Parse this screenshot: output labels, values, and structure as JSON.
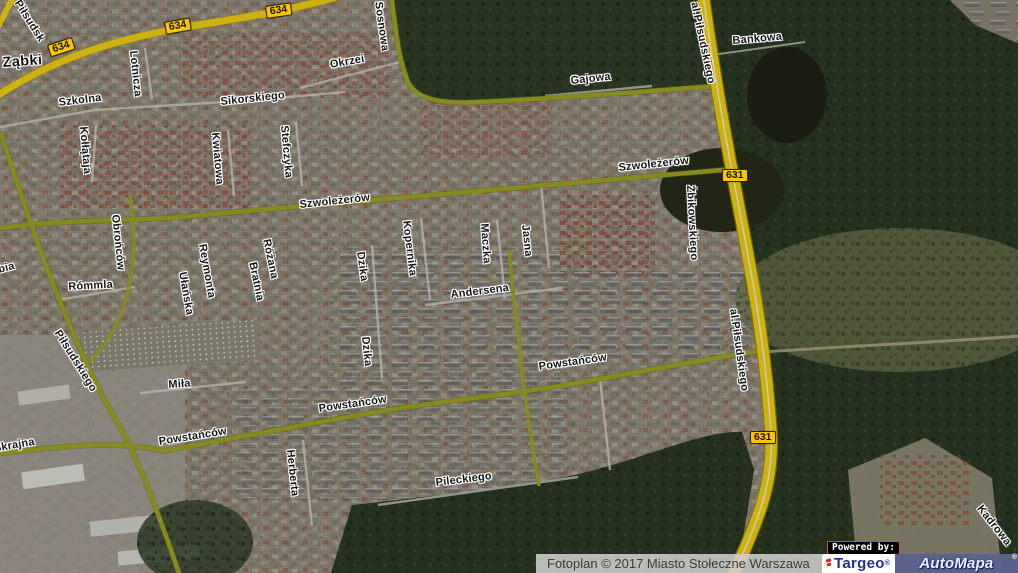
{
  "map": {
    "town_label": {
      "text": "Ząbki",
      "x": 2,
      "y": 55,
      "rot": -4
    },
    "street_labels": [
      {
        "text": "Piłsudsk",
        "x": 22,
        "y": -2,
        "rot": 58
      },
      {
        "text": "Lotnicza",
        "x": 139,
        "y": 50,
        "rot": 84
      },
      {
        "text": "Szkolna",
        "x": 58,
        "y": 97,
        "rot": -7
      },
      {
        "text": "Sikorskiego",
        "x": 220,
        "y": 96,
        "rot": -6
      },
      {
        "text": "Okrzei",
        "x": 329,
        "y": 59,
        "rot": -10
      },
      {
        "text": "Sosnowa",
        "x": 384,
        "y": 1,
        "rot": 82
      },
      {
        "text": "Gajowa",
        "x": 570,
        "y": 75,
        "rot": -6
      },
      {
        "text": "Bankowa",
        "x": 732,
        "y": 35,
        "rot": -5
      },
      {
        "text": "al.Piłsudskiego",
        "x": 700,
        "y": 1,
        "rot": 78
      },
      {
        "text": "Kołłątaja",
        "x": 89,
        "y": 126,
        "rot": 85
      },
      {
        "text": "Kwiatowa",
        "x": 221,
        "y": 132,
        "rot": 85
      },
      {
        "text": "Stefczyka",
        "x": 290,
        "y": 125,
        "rot": 85
      },
      {
        "text": "Szwoleżerów",
        "x": 299,
        "y": 199,
        "rot": -6
      },
      {
        "text": "Szwoleżerów",
        "x": 618,
        "y": 162,
        "rot": -6
      },
      {
        "text": "Żbikowskiego",
        "x": 696,
        "y": 185,
        "rot": 87
      },
      {
        "text": "Obrońców",
        "x": 121,
        "y": 214,
        "rot": 84
      },
      {
        "text": "Rómmla",
        "x": 68,
        "y": 281,
        "rot": -3
      },
      {
        "text": "bia",
        "x": -3,
        "y": 264,
        "rot": -14
      },
      {
        "text": "Reymonta",
        "x": 208,
        "y": 243,
        "rot": 80
      },
      {
        "text": "Ułańska",
        "x": 188,
        "y": 271,
        "rot": 80
      },
      {
        "text": "Różana",
        "x": 272,
        "y": 238,
        "rot": 78
      },
      {
        "text": "Bratnia",
        "x": 258,
        "y": 261,
        "rot": 78
      },
      {
        "text": "Dzika",
        "x": 366,
        "y": 251,
        "rot": 82
      },
      {
        "text": "Kopernika",
        "x": 412,
        "y": 220,
        "rot": 83
      },
      {
        "text": "Maczka",
        "x": 490,
        "y": 223,
        "rot": 86
      },
      {
        "text": "Jasna",
        "x": 531,
        "y": 224,
        "rot": 84
      },
      {
        "text": "Andersena",
        "x": 450,
        "y": 289,
        "rot": -7
      },
      {
        "text": "Piłsudskiego",
        "x": 62,
        "y": 328,
        "rot": 58
      },
      {
        "text": "Miła",
        "x": 168,
        "y": 379,
        "rot": -4
      },
      {
        "text": "Dzika",
        "x": 371,
        "y": 336,
        "rot": 84
      },
      {
        "text": "Powstańców",
        "x": 158,
        "y": 436,
        "rot": -9
      },
      {
        "text": "Powstańców",
        "x": 318,
        "y": 403,
        "rot": -8
      },
      {
        "text": "Powstańców",
        "x": 538,
        "y": 361,
        "rot": -8
      },
      {
        "text": "Herberta",
        "x": 296,
        "y": 449,
        "rot": 84
      },
      {
        "text": "Pileckiego",
        "x": 435,
        "y": 477,
        "rot": -7
      },
      {
        "text": "Skrajna",
        "x": -7,
        "y": 443,
        "rot": -10
      },
      {
        "text": "al.Piłsudskiego",
        "x": 739,
        "y": 308,
        "rot": 82
      },
      {
        "text": "Kadrowa",
        "x": 984,
        "y": 503,
        "rot": 52
      }
    ],
    "road_badges": [
      {
        "number": "634",
        "x": 47,
        "y": 45,
        "rot": -18
      },
      {
        "number": "634",
        "x": 164,
        "y": 22,
        "rot": -10
      },
      {
        "number": "634",
        "x": 265,
        "y": 6,
        "rot": -8
      },
      {
        "number": "631",
        "x": 722,
        "y": 169,
        "rot": 0
      },
      {
        "number": "631",
        "x": 750,
        "y": 431,
        "rot": 0
      }
    ],
    "colors": {
      "major_road_yellow": "#eecf14",
      "minor_road_olive": "#9da226",
      "badge_background": "#f8c701",
      "forest_green": "#2c3a25"
    }
  },
  "attribution": {
    "fotoplan_text": "Fotoplan © 2017 Miasto Stołeczne Warszawa",
    "powered_by": "Powered by:",
    "targeo": "Targeo",
    "targeo_mark": "®",
    "automapa": "AutoMapa",
    "automapa_mark": "®"
  }
}
